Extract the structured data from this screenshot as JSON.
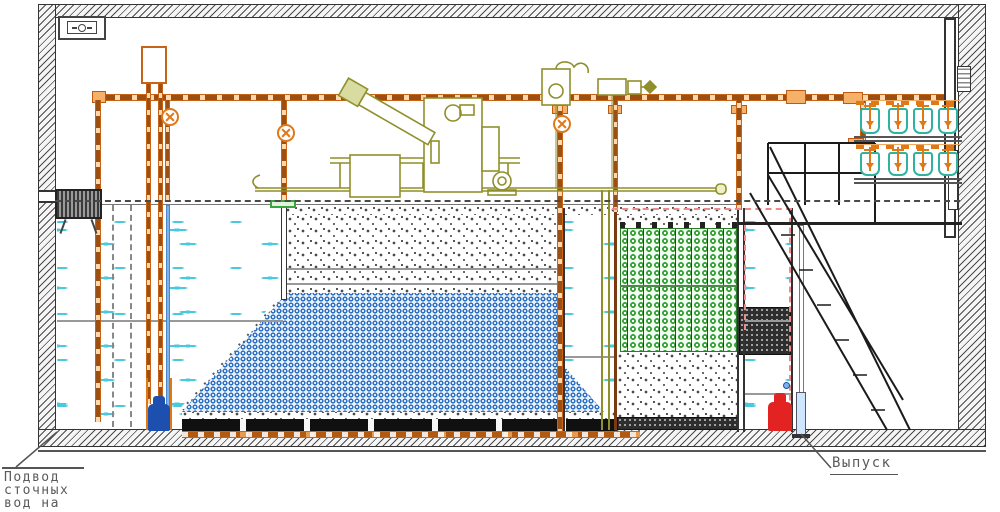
{
  "labels": {
    "inlet_lines": [
      "Подвод",
      "сточных",
      "вод на",
      "очистку"
    ],
    "outlet": "Выпуск"
  },
  "equipment": {
    "diffuser_rows": 2,
    "diffusers_per_row": 4
  },
  "colors": {
    "pipe_orange": "#c86418",
    "equipment_olive": "#8f8f2b",
    "water_dash": "#49c9de",
    "media_blue": "#2e6fc0",
    "media_green": "#33a033",
    "media_dark": "#2e2e2e",
    "pump_inlet_blue": "#1d4fae",
    "pump_outlet_red": "#e32222",
    "annotation_pink": "#f08a8a",
    "structure_gray": "#4a4a4a"
  }
}
